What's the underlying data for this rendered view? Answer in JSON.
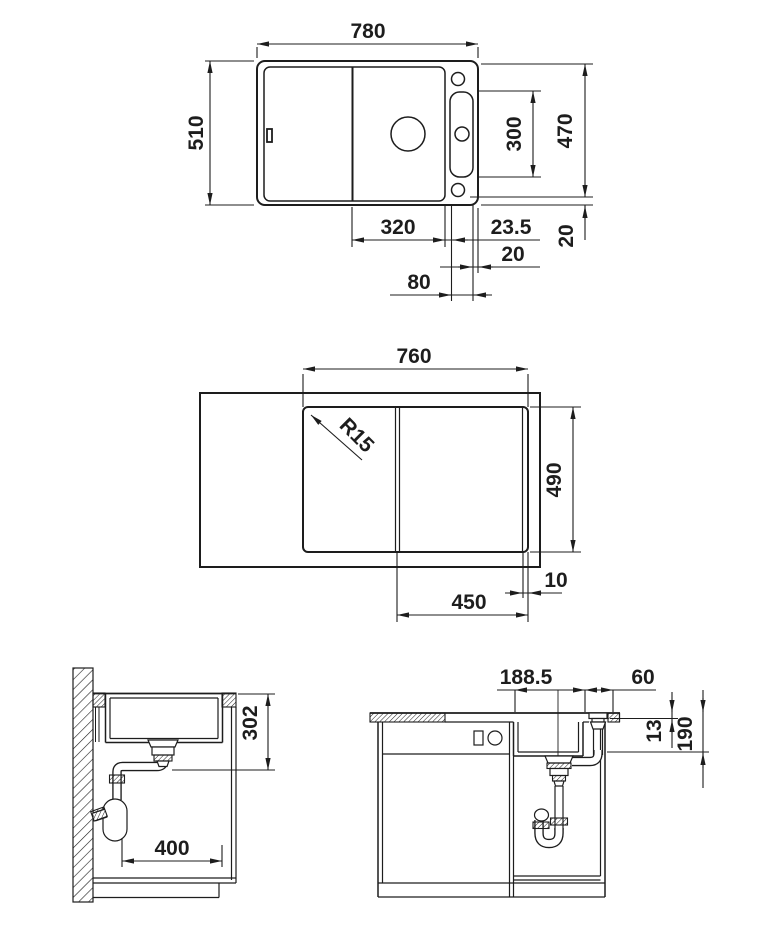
{
  "drawing": {
    "title": "Kitchen sink installation technical drawing",
    "line_color": "#1d1d1d",
    "background_color": "#ffffff",
    "views": {
      "plan": {
        "overall_width": "780",
        "overall_depth": "510",
        "tap_ledge_depth": "470",
        "tap_hole_span": "300",
        "bowl_width": "320",
        "ledge_offset": "23.5",
        "edge_gap": "20",
        "rear_gap": "20",
        "tap_panel_width": "80"
      },
      "cutout": {
        "width": "760",
        "corner_radius": "R15",
        "depth": "490",
        "bowl_cutout": "450",
        "edge_strip": "10"
      },
      "side_section": {
        "bowl_depth": "302",
        "drain_offset": "400"
      },
      "front_section": {
        "drain_span": "188.5",
        "control_offset": "60",
        "rim_height": "13",
        "bowl_depth": "190"
      }
    }
  }
}
